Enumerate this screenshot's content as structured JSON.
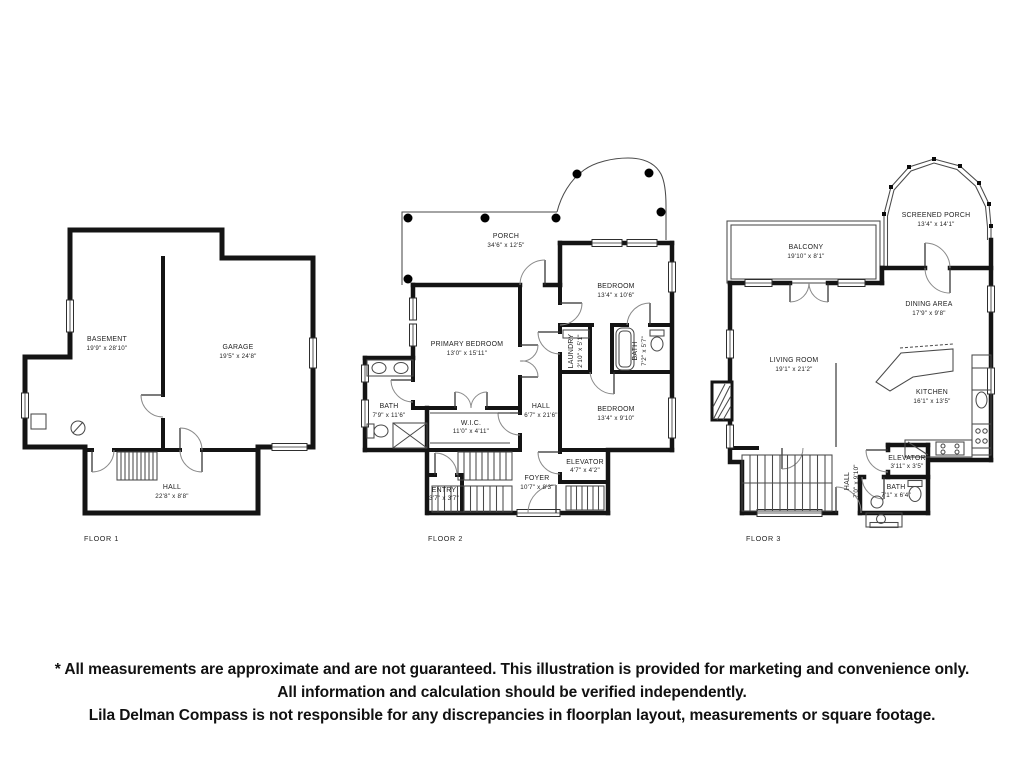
{
  "colors": {
    "wall": "#141414",
    "background": "#ffffff",
    "text": "#232323"
  },
  "floors": [
    {
      "label": "FLOOR 1",
      "rooms": {
        "basement": {
          "name": "BASEMENT",
          "dims": "19'9\" x 28'10\""
        },
        "garage": {
          "name": "GARAGE",
          "dims": "19'5\" x 24'8\""
        },
        "hall": {
          "name": "HALL",
          "dims": "22'8\" x 8'8\""
        }
      }
    },
    {
      "label": "FLOOR 2",
      "rooms": {
        "porch": {
          "name": "PORCH",
          "dims": "34'6\" x 12'5\""
        },
        "bedroom1": {
          "name": "BEDROOM",
          "dims": "13'4\" x 10'6\""
        },
        "primary": {
          "name": "PRIMARY BEDROOM",
          "dims": "13'0\" x 15'11\""
        },
        "bath1": {
          "name": "BATH",
          "dims": "7'9\" x 11'6\""
        },
        "wic": {
          "name": "W.I.C.",
          "dims": "11'0\" x 4'11\""
        },
        "hall": {
          "name": "HALL",
          "dims": "6'7\" x 21'6\""
        },
        "laundry": {
          "name": "LAUNDRY",
          "dims": "2'10\" x 5'1\""
        },
        "bath2": {
          "name": "BATH",
          "dims": "7'2\" x 5'7\""
        },
        "bedroom2": {
          "name": "BEDROOM",
          "dims": "13'4\" x 9'10\""
        },
        "elevator": {
          "name": "ELEVATOR",
          "dims": "4'7\" x 4'2\""
        },
        "foyer": {
          "name": "FOYER",
          "dims": "10'7\" x 8'3\""
        },
        "entry": {
          "name": "ENTRY",
          "dims": "3'7\" x 3'7\""
        }
      }
    },
    {
      "label": "FLOOR 3",
      "rooms": {
        "screened_porch": {
          "name": "SCREENED PORCH",
          "dims": "13'4\" x 14'1\""
        },
        "balcony": {
          "name": "BALCONY",
          "dims": "19'10\" x 8'1\""
        },
        "dining": {
          "name": "DINING AREA",
          "dims": "17'9\" x 9'8\""
        },
        "living": {
          "name": "LIVING ROOM",
          "dims": "19'1\" x 21'2\""
        },
        "kitchen": {
          "name": "KITCHEN",
          "dims": "16'1\" x 13'5\""
        },
        "elevator": {
          "name": "ELEVATOR",
          "dims": "3'11\" x 3'5\""
        },
        "hall": {
          "name": "HALL",
          "dims": "7'0\" x 9'10\""
        },
        "bath": {
          "name": "BATH",
          "dims": "7'1\" x 6'4\""
        }
      }
    }
  ],
  "disclaimer": {
    "line1": "* All measurements are approximate and are not guaranteed. This illustration is provided for marketing and convenience only.",
    "line2": "All information and calculation should be verified independently.",
    "line3": "Lila Delman Compass  is not responsible for any discrepancies in floorplan layout, measurements or square footage."
  }
}
